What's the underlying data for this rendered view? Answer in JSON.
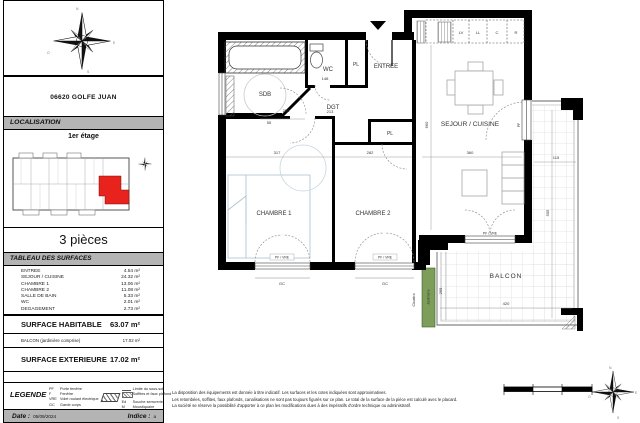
{
  "compass": {
    "n": "N",
    "e": "E",
    "s": "S",
    "o": "O"
  },
  "sidebar": {
    "address": "06620 GOLFE JUAN",
    "localisation_header": "LOCALISATION",
    "floor_label": "1er étage",
    "pieces_label": "3 pièces",
    "surfaces_header": "TABLEAU DES SURFACES",
    "surfaces": [
      {
        "label": "ENTREE",
        "value": "4.54 m²"
      },
      {
        "label": "SEJOUR / CUISINE",
        "value": "24.32 m²"
      },
      {
        "label": "CHAMBRE 1",
        "value": "13.06 m²"
      },
      {
        "label": "CHAMBRE 2",
        "value": "11.08 m²"
      },
      {
        "label": "SALLE DE BAIN",
        "value": "5.33 m²"
      },
      {
        "label": "WC",
        "value": "2.01 m²"
      },
      {
        "label": "DEGAGEMENT",
        "value": "2.73 m²"
      }
    ],
    "habitable_label": "SURFACE HABITABLE",
    "habitable_value": "63.07 m²",
    "balcon_label": "BALCON (jardinière comprise)",
    "balcon_value": "17.02 m²",
    "exterieure_label": "SURFACE EXTERIEURE",
    "exterieure_value": "17.02 m²",
    "legend": {
      "title": "LEGENDE",
      "abbr": [
        {
          "key": "PF",
          "label": "Porte fenêtre"
        },
        {
          "key": "F",
          "label": "Fenêtre"
        },
        {
          "key": "VRE",
          "label": "Volet roulant électrique"
        },
        {
          "key": "GC",
          "label": "Garde corps"
        }
      ],
      "symbols": [
        {
          "key": "",
          "label": "Limite du sous-sol"
        },
        {
          "key": "",
          "label": "Soffites et faux plafond"
        },
        {
          "key": "Ed",
          "label": "Souche serrurerie"
        },
        {
          "key": "M",
          "label": "Moustiquaire"
        }
      ]
    },
    "date_label": "Date :",
    "date_value": "05/09/2024",
    "indice_label": "Indice :",
    "indice_value": "a"
  },
  "plan": {
    "rooms": {
      "sdb": "SDB",
      "wc": "WC",
      "pl1": "PL",
      "entree": "ENTREE",
      "dgt": "DGT",
      "pl2": "PL",
      "chambre1": "CHAMBRE 1",
      "chambre2": "CHAMBRE 2",
      "sejour": "SEJOUR / CUISINE",
      "balcon": "BALCON"
    },
    "annotations": {
      "jardiniere": "Jardinière",
      "claustra": "Claustra",
      "gc1": "GC",
      "gc2": "GC",
      "pf_vre1": "PF / VRE",
      "pf_vre2": "PF / VRE",
      "pf_door": "PF",
      "kitchen": {
        "lv": "LV",
        "ll": "LL",
        "c": "C",
        "r": "R"
      }
    },
    "dimensions": {
      "sdb_w": "208",
      "sdb_door": "55",
      "wc_w": "148",
      "dgt_w": "213",
      "ch1_w": "317",
      "ch2_w": "282",
      "sejour_w": "360",
      "sejour_h": "660",
      "balcon_strip_w": "115",
      "balcon_w": "420",
      "balcon_h": "255",
      "balcon_side_h": "505"
    }
  },
  "footer": {
    "disclaimer1": "La disposition des équipements est donnée à titre indicatif. Les surfaces et les cotes indiquées sont approximatives.",
    "disclaimer2": "Les retombées, soffites, faux plafonds, canalisations ne sont pas toujours figurés sur ce plan. Le total de la surface de la pièce est calculé avec le placard.",
    "disclaimer3": "La société se réserve la possibilité d'apporter à ce plan les modifications dues à des impératifs d'ordre technique ou administratif."
  },
  "colors": {
    "unit_red": "#e8231d",
    "jardiniere_green": "#7d9e58",
    "header_gray": "#b4b4b4"
  }
}
